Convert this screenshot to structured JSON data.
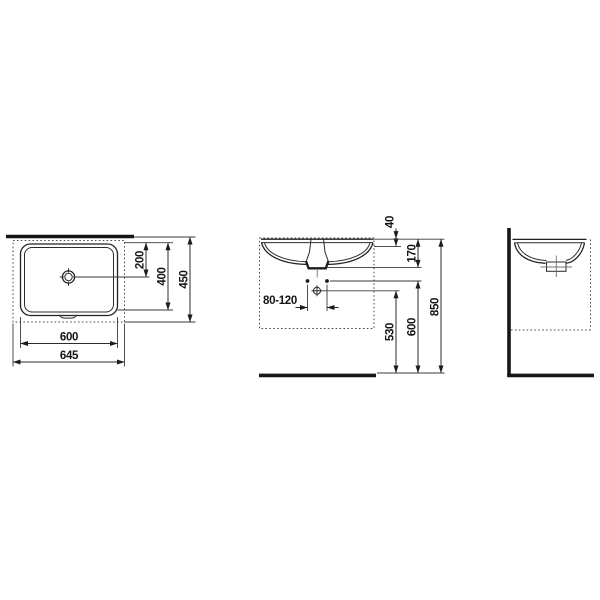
{
  "drawing_type": "washbasin installation drawing, three orthographic views",
  "colors": {
    "background": "#ffffff",
    "line": "#2b2b2b",
    "heavy_line": "#161616",
    "label_text": "#141414"
  },
  "dimensions_mm": {
    "top_view": {
      "drain_offset": "200",
      "basin_depth": "400",
      "overall_depth": "450",
      "basin_width": "600",
      "overall_width": "645"
    },
    "front_view": {
      "rim_to_flange": "40",
      "rim_to_outlet": "170",
      "tap_hole_spacing": "80-120",
      "trap_height": "530",
      "fixing_height": "600",
      "rim_height": "850"
    }
  }
}
